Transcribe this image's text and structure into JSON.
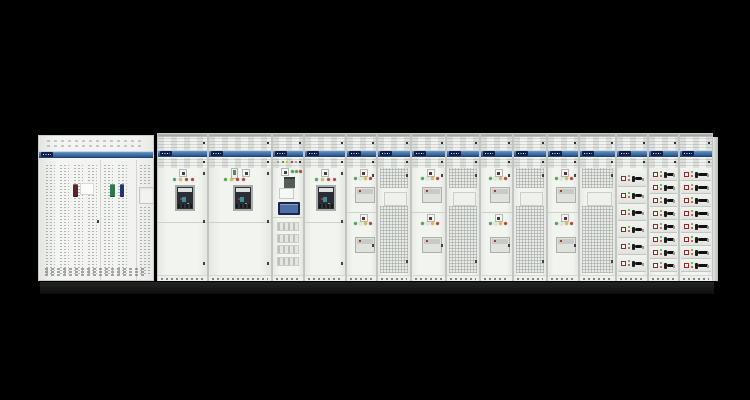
{
  "meta": {
    "description": "Photograph of a low-voltage electrical switchboard lineup of white cabinets with a blue brand band, on a black background",
    "width": 750,
    "height": 400
  },
  "palette": {
    "background": "#000000",
    "cabinet_body": "#f1f2ef",
    "cabinet_edge": "#c2c5c1",
    "band_blue": "#3f74a8",
    "band_blue_dark": "#1e3f6a",
    "logo_navy": "#0f1f4a",
    "plinth": "#141414",
    "led_green": "#44a84c",
    "led_yellow": "#d6c23c",
    "led_red": "#c03c34",
    "handle_maroon": "#5f222c",
    "handle_green": "#2e7a4c",
    "handle_navy": "#27336e",
    "acb_dark": "#2a2d33",
    "acb_frame": "#a8ada9",
    "hmi_bezel": "#192649",
    "hmi_screen": "#4d6ea6",
    "drawer_handle": "#111111",
    "drawer_indicator_border": "#8c2a28"
  },
  "leds": {
    "acb_sequence": [
      "green",
      "yellow",
      "red",
      "red"
    ],
    "feeder_sequence": [
      "green",
      "pale",
      "yellow",
      "red"
    ],
    "metering_sequence": [
      "green",
      "green",
      "red"
    ],
    "mini_row_sequence": [
      "gray",
      "green",
      "yellow",
      "red",
      "gray"
    ]
  },
  "lineup": {
    "bays": [
      {
        "id": "incomer-perforated-cabinet",
        "type": "perforated",
        "x": 38,
        "w": 116,
        "handles": [
          "maroon",
          "green",
          "navy"
        ]
      },
      {
        "id": "acb-bay-1",
        "type": "acb",
        "x": 157,
        "w": 51,
        "ctrl_x": 21,
        "led_x": 15,
        "acb_x": 17,
        "devices": [
          "controller"
        ]
      },
      {
        "id": "acb-bay-2",
        "type": "acb",
        "x": 208,
        "w": 64,
        "ctrl_x": 33,
        "led_x": 15,
        "acb_x": 24,
        "devices": [
          "meter",
          "controller"
        ]
      },
      {
        "id": "metering-hmi-bay",
        "type": "metering",
        "x": 272,
        "w": 32
      },
      {
        "id": "acb-bay-3",
        "type": "acb",
        "x": 304,
        "w": 42,
        "ctrl_x": 16,
        "led_x": 10,
        "acb_x": 11,
        "devices": [
          "controller"
        ]
      },
      {
        "id": "feeder-bay-1",
        "type": "feeder",
        "x": 346,
        "w": 31
      },
      {
        "id": "mesh-bay-1",
        "type": "mesh",
        "x": 377,
        "w": 34
      },
      {
        "id": "feeder-bay-2",
        "type": "feeder",
        "x": 411,
        "w": 35
      },
      {
        "id": "mesh-bay-2",
        "type": "mesh",
        "x": 446,
        "w": 34
      },
      {
        "id": "feeder-bay-3",
        "type": "feeder",
        "x": 480,
        "w": 33
      },
      {
        "id": "mesh-bay-3",
        "type": "mesh",
        "x": 513,
        "w": 34
      },
      {
        "id": "feeder-bay-4",
        "type": "feeder",
        "x": 547,
        "w": 32
      },
      {
        "id": "mesh-bay-4",
        "type": "mesh",
        "x": 579,
        "w": 37
      },
      {
        "id": "drawer-bay-1",
        "type": "drawers",
        "x": 616,
        "w": 32,
        "drawer_count": 6,
        "handle_wide": false
      },
      {
        "id": "drawer-bay-2",
        "type": "drawers",
        "x": 648,
        "w": 31,
        "drawer_count": 8,
        "handle_wide": false
      },
      {
        "id": "drawer-bay-3",
        "type": "drawers",
        "x": 679,
        "w": 34,
        "drawer_count": 8,
        "handle_wide": true
      }
    ],
    "end_panel": {
      "x": 713,
      "w": 5
    },
    "plinth": {
      "x": 40,
      "w": 674,
      "y": 281,
      "h": 12
    }
  }
}
